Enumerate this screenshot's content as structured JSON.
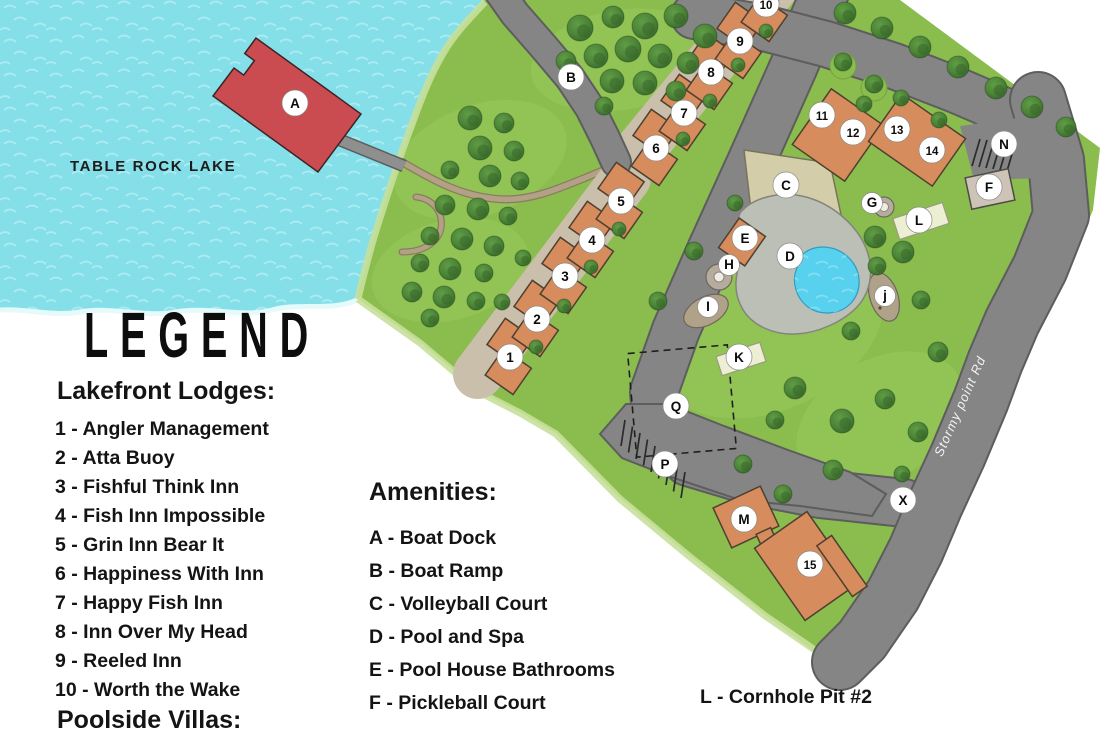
{
  "map": {
    "lake_label": "TABLE ROCK LAKE",
    "road_label": "Stormy point Rd",
    "markers": [
      {
        "label": "A",
        "x": 295,
        "y": 103
      },
      {
        "label": "B",
        "x": 571,
        "y": 77
      },
      {
        "label": "1",
        "x": 510,
        "y": 357
      },
      {
        "label": "2",
        "x": 537,
        "y": 319
      },
      {
        "label": "3",
        "x": 565,
        "y": 276
      },
      {
        "label": "4",
        "x": 592,
        "y": 240
      },
      {
        "label": "5",
        "x": 621,
        "y": 201
      },
      {
        "label": "6",
        "x": 656,
        "y": 148
      },
      {
        "label": "7",
        "x": 684,
        "y": 113
      },
      {
        "label": "8",
        "x": 711,
        "y": 72
      },
      {
        "label": "9",
        "x": 740,
        "y": 41
      },
      {
        "label": "10",
        "x": 766,
        "y": 4
      },
      {
        "label": "11",
        "x": 822,
        "y": 115
      },
      {
        "label": "12",
        "x": 853,
        "y": 132
      },
      {
        "label": "13",
        "x": 897,
        "y": 129
      },
      {
        "label": "14",
        "x": 932,
        "y": 150
      },
      {
        "label": "N",
        "x": 1004,
        "y": 144
      },
      {
        "label": "F",
        "x": 989,
        "y": 187
      },
      {
        "label": "C",
        "x": 786,
        "y": 185
      },
      {
        "label": "G",
        "x": 872,
        "y": 203,
        "r": 10.5
      },
      {
        "label": "L",
        "x": 919,
        "y": 220
      },
      {
        "label": "E",
        "x": 745,
        "y": 238
      },
      {
        "label": "D",
        "x": 790,
        "y": 256
      },
      {
        "label": "H",
        "x": 729,
        "y": 265,
        "r": 10.5
      },
      {
        "label": "I",
        "x": 708,
        "y": 307,
        "r": 10.5
      },
      {
        "label": "j",
        "x": 885,
        "y": 296,
        "r": 10.5
      },
      {
        "label": "K",
        "x": 739,
        "y": 357
      },
      {
        "label": "Q",
        "x": 676,
        "y": 406
      },
      {
        "label": "P",
        "x": 665,
        "y": 464
      },
      {
        "label": "X",
        "x": 903,
        "y": 500
      },
      {
        "label": "M",
        "x": 744,
        "y": 519
      },
      {
        "label": "15",
        "x": 810,
        "y": 564
      }
    ]
  },
  "legend": {
    "title": "LEGEND",
    "lodges_heading": "Lakefront Lodges:",
    "lodges": [
      "1 - Angler Management",
      "2 - Atta Buoy",
      "3 - Fishful Think Inn",
      "4 - Fish Inn Impossible",
      "5 - Grin Inn Bear It",
      "6 - Happiness With Inn",
      "7 - Happy Fish Inn",
      "8 - Inn Over My Head",
      "9 - Reeled Inn",
      "10 - Worth the Wake"
    ],
    "partial_heading": "Poolside Villas:",
    "amenities_heading": "Amenities:",
    "amenities": [
      "A - Boat Dock",
      "B - Boat Ramp",
      "C - Volleyball Court",
      "D - Pool and Spa",
      "E - Pool House Bathrooms",
      "F - Pickleball Court"
    ],
    "amenities_extra": "L - Cornhole Pit #2"
  },
  "colors": {
    "water": "#85dfe9",
    "grass": "#8abd4d",
    "road": "#858585",
    "building": "#d68c5c",
    "dock": "#ca4b50",
    "tree": "#4c8538",
    "court_sand": "#d4cda9",
    "pool": "#58d1ee",
    "pool_deck": "#bcbfb6",
    "courtyard": "#c9bfab"
  }
}
